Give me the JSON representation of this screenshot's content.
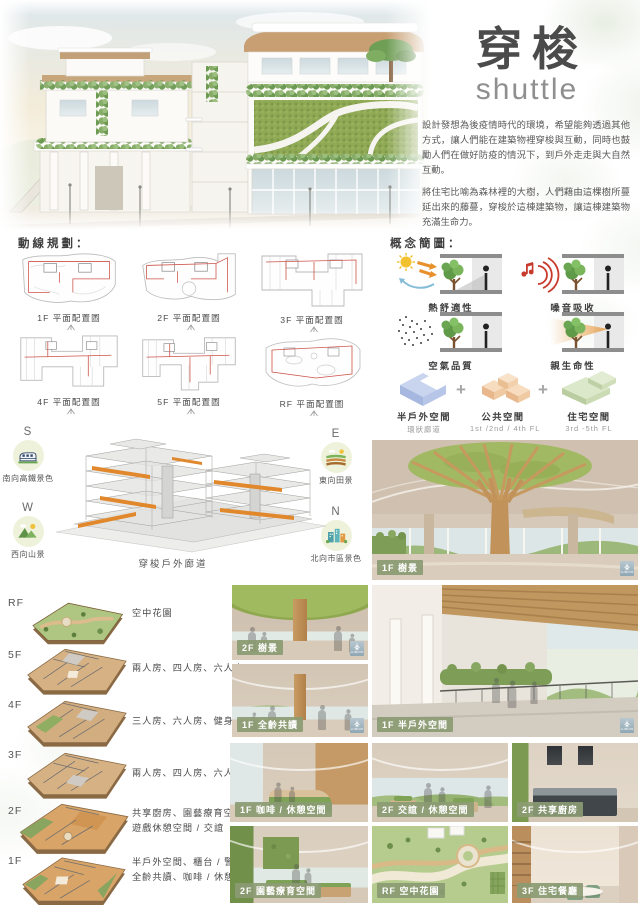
{
  "poster": {
    "title": "穿梭",
    "subtitle": "shuttle",
    "intro": [
      "設計發想為後疫情時代的環境，希望能夠透過其他方式，讓人們能在建築物裡穿梭與互動，同時也鼓勵人們在做好防疫的情況下，到戶外走走與大自然互動。",
      "將住宅比喻為森林裡的大樹，人們藉由這棵樹所蔓延出來的藤蔓，穿梭於這棟建築物，讓這棟建築物充滿生命力。"
    ]
  },
  "palette": {
    "accent_orange": "#e0882b",
    "circulation_red": "#cc5348",
    "chip_green": "#8b9b73",
    "title_gray": "#4b4b4b",
    "massing_blue": "#c9d4ee",
    "massing_peach": "#f4cfab",
    "massing_green": "#d2e2c0"
  },
  "circulation": {
    "heading": "動線規劃：",
    "plans": [
      {
        "label": "1F 平面配置圖"
      },
      {
        "label": "2F 平面配置圖"
      },
      {
        "label": "3F 平面配置圖"
      },
      {
        "label": "4F 平面配置圖"
      },
      {
        "label": "5F 平面配置圖"
      },
      {
        "label": "RF 平面配置圖"
      }
    ]
  },
  "concept": {
    "heading": "概念簡圖：",
    "plus": "+",
    "cells": [
      {
        "label": "熱舒適性"
      },
      {
        "label": "噪音吸收"
      },
      {
        "label": "空氣品質"
      },
      {
        "label": "親生命性"
      }
    ],
    "massing": [
      {
        "label": "半戶外空間",
        "sub": "環狀廊道"
      },
      {
        "label": "公共空間",
        "sub": "1st /2nd / 4th FL"
      },
      {
        "label": "住宅空間",
        "sub": "3rd -5th FL"
      }
    ]
  },
  "axon": {
    "caption": "穿梭戶外廊道",
    "directions": [
      {
        "letter": "S",
        "label": "南向高鐵景色"
      },
      {
        "letter": "W",
        "label": "西向山景"
      },
      {
        "letter": "E",
        "label": "東向田景"
      },
      {
        "letter": "N",
        "label": "北向市區景色"
      }
    ]
  },
  "floors": [
    {
      "level": "RF",
      "line1": "空中花園",
      "line2": ""
    },
    {
      "level": "5F",
      "line1": "兩人房、四人房、六人房",
      "line2": ""
    },
    {
      "level": "4F",
      "line1": "三人房、六人房、健身房",
      "line2": ""
    },
    {
      "level": "3F",
      "line1": "兩人房、四人房、六人房",
      "line2": ""
    },
    {
      "level": "2F",
      "line1": "共享廚房、園藝療育空間",
      "line2": "遊戲休憩空間 / 交誼"
    },
    {
      "level": "1F",
      "line1": "半戶外空間、櫃台 / 警衛區",
      "line2": "全齡共讀、咖啡 / 休憩區"
    }
  ],
  "gallery": {
    "watermark": "LUMION",
    "items": [
      {
        "label": "1F 樹景"
      },
      {
        "label": "2F 樹景"
      },
      {
        "label": "1F 全齡共讀"
      },
      {
        "label": "1F 半戶外空間"
      },
      {
        "label": "1F 咖啡 / 休憩空間"
      },
      {
        "label": "2F 交誼 / 休憩空間"
      },
      {
        "label": "2F 共享廚房"
      },
      {
        "label": "2F 園藝療育空間"
      },
      {
        "label": "RF 空中花園"
      },
      {
        "label": "3F 住宅餐廳"
      }
    ]
  }
}
